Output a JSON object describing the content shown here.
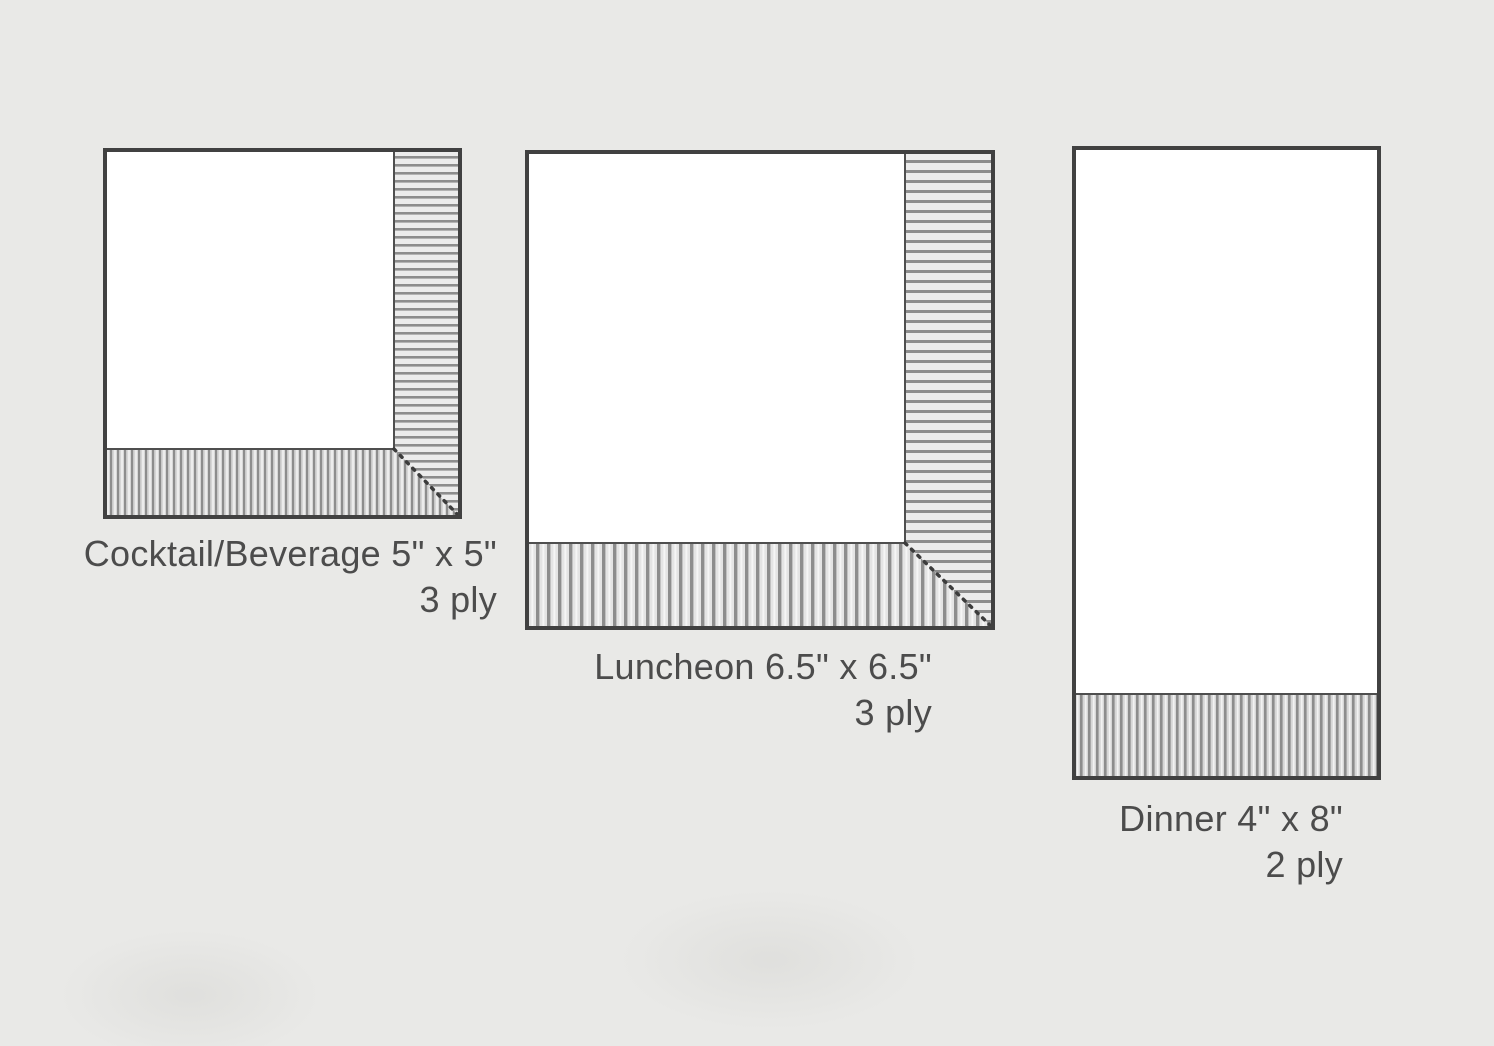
{
  "page": {
    "background_color": "#e9e9e7"
  },
  "diagram": {
    "type": "napkin-size-comparison",
    "colors": {
      "outline": "#414141",
      "inner_edge": "#4f4f4f",
      "hatch_line": "#8d8d8d",
      "napkin_fill": "#ffffff",
      "text": "#4c4c4c"
    },
    "napkins": [
      {
        "name": "Cocktail/Beverage",
        "size": "5\" x 5\"",
        "label": "Cocktail/Beverage 5\" x 5\"",
        "ply": "3 ply"
      },
      {
        "name": "Luncheon",
        "size": "6.5\" x 6.5\"",
        "label": "Luncheon 6.5\" x 6.5\"",
        "ply": "3 ply"
      },
      {
        "name": "Dinner",
        "size": "4\" x 8\"",
        "label": "Dinner 4\" x 8\"",
        "ply": "2 ply"
      }
    ]
  }
}
